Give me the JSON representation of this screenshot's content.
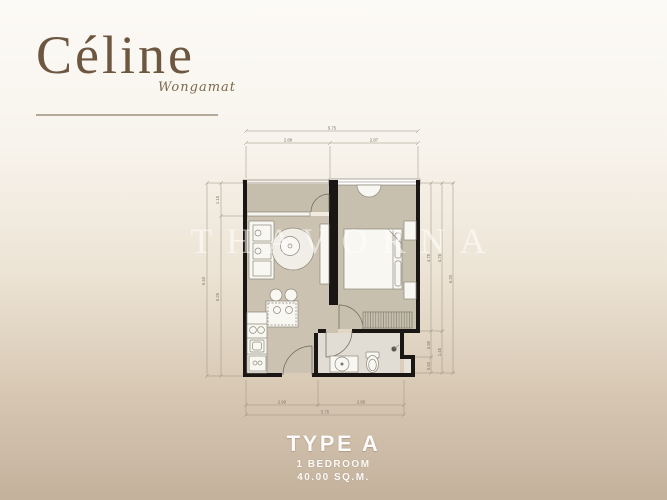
{
  "logo": {
    "name": "Céline",
    "subtitle": "Wongamat"
  },
  "watermark": "THAVORNA",
  "type_block": {
    "title": "TYPE A",
    "bedroom": "1 BEDROOM",
    "area": "40.00 SQ.M."
  },
  "dimensions": {
    "top": {
      "total": "5.75",
      "seg1": "2.88",
      "seg2": "2.87"
    },
    "bottom": {
      "total": "5.75",
      "seg1": "2.90",
      "seg2": "2.85"
    },
    "left": {
      "total": "6.40",
      "seg1": "1.15",
      "seg2": "5.25"
    },
    "right": {
      "total": "6.20",
      "inner1": "4.75",
      "inner2": "0.90",
      "inner3": "0.60",
      "mid1": "4.75",
      "mid2": "1.45"
    }
  },
  "colors": {
    "brand_brown": "#6d5740",
    "wall_black": "#191613",
    "floor_tan": "#cdc5b4",
    "background_top": "#fcfaf6",
    "background_bottom": "#c3b19c",
    "label_white": "#fdfcfa"
  }
}
